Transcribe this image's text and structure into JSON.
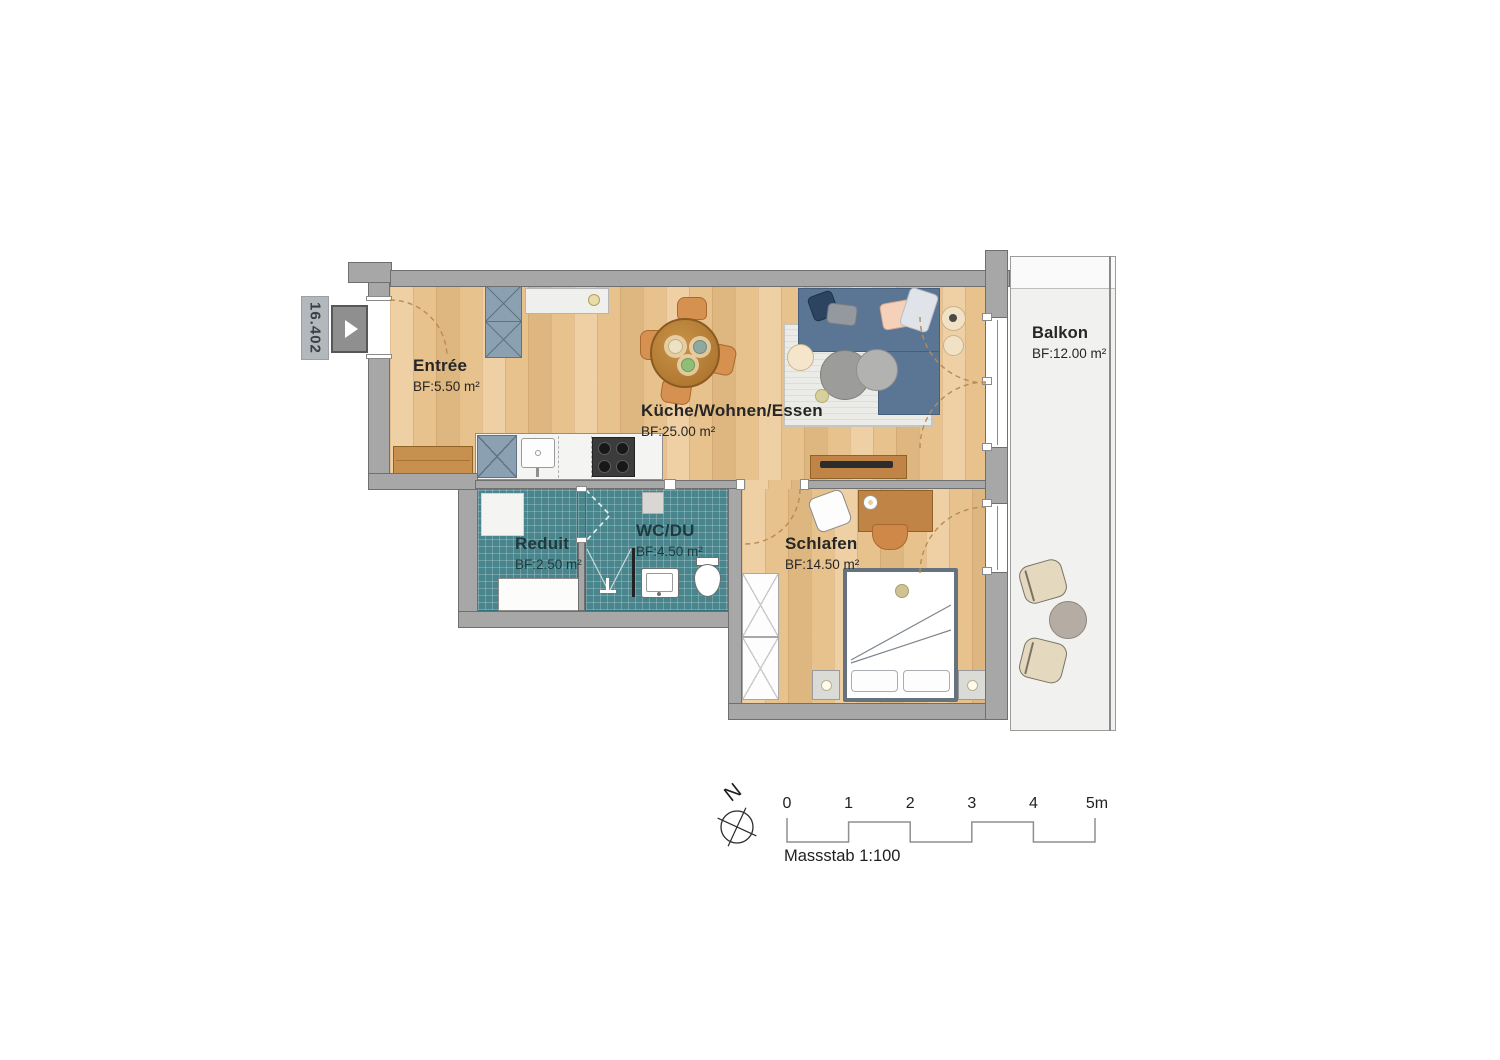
{
  "plan": {
    "unit_label": "16.402",
    "rooms": [
      {
        "id": "entree",
        "name": "Entrée",
        "area": "BF:5.50 m²"
      },
      {
        "id": "kueche",
        "name": "Küche/Wohnen/Essen",
        "area": "BF:25.00 m²"
      },
      {
        "id": "reduit",
        "name": "Reduit",
        "area": "BF:2.50 m²"
      },
      {
        "id": "wcdu",
        "name": "WC/DU",
        "area": "BF:4.50 m²"
      },
      {
        "id": "schlafen",
        "name": "Schlafen",
        "area": "BF:14.50 m²"
      },
      {
        "id": "balkon",
        "name": "Balkon",
        "area": "BF:12.00 m²"
      }
    ],
    "compass": {
      "north_label": "N"
    },
    "scale_bar": {
      "ticks": [
        "0",
        "1",
        "2",
        "3",
        "4",
        "5m"
      ],
      "caption": "Massstab 1:100"
    },
    "colors": {
      "wall": "#a7a7a7",
      "wood_floor": "#e8c28d",
      "bathroom_tile": "#48858d",
      "sofa": "#5a7694",
      "furniture_wood": "#c08447",
      "balcony": "#f1f1f0",
      "unit_label_bg": "#b3b8bd"
    }
  }
}
